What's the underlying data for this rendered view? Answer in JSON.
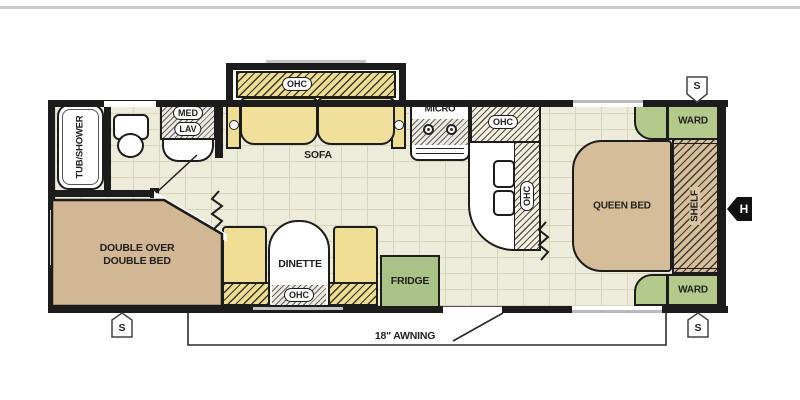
{
  "floorplan": {
    "bathroom": {
      "tub_shower": "TUB/SHOWER",
      "med": "MED",
      "lav": "LAV"
    },
    "living_area": {
      "sofa": "SOFA",
      "sofa_ohc": "OHC"
    },
    "kitchen": {
      "micro": "MICRO",
      "upper_cabinet": "OHC",
      "side_cabinet": "OHC",
      "fridge": "FRIDGE"
    },
    "dinette": {
      "name": "DINETTE",
      "ohc": "OHC"
    },
    "front_bedroom": {
      "bed_line1": "DOUBLE OVER",
      "bed_line2": "DOUBLE BED"
    },
    "rear_bedroom": {
      "bed": "QUEEN BED",
      "shelf": "SHELF",
      "ward_top": "WARD",
      "ward_bottom": "WARD"
    },
    "exterior": {
      "awning": "18\" AWNING",
      "speaker_top": "S",
      "speaker_bottom_right": "S",
      "speaker_bottom_left": "S",
      "hitch": "H"
    },
    "colors": {
      "wood": "#eedd92",
      "bed_tan": "#d2b794",
      "cabinet_green": "#afc78b",
      "floor": "#edebd9",
      "wall": "#1c1c1c"
    }
  }
}
